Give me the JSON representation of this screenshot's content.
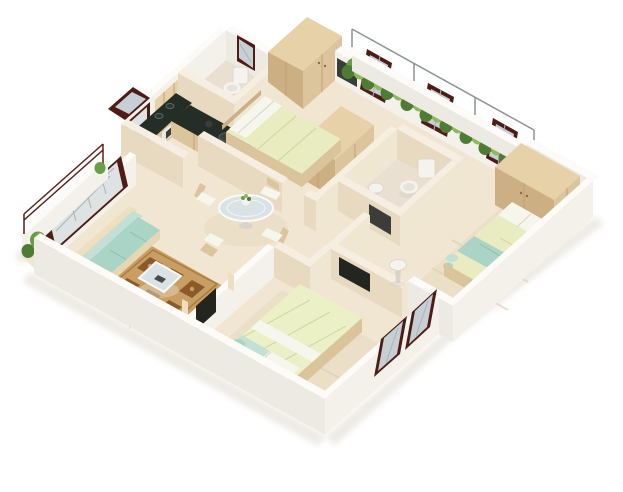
{
  "scene": {
    "type": "isometric-3d-floor-plan-render",
    "bedrooms": 3,
    "bathrooms": 2,
    "rooms": [
      "living-room",
      "kitchen",
      "dining-area",
      "hallway",
      "bathroom-1",
      "bathroom-2",
      "bedroom-1",
      "bedroom-2",
      "bedroom-3",
      "balcony-terrace",
      "left-balcony",
      "vestibule"
    ],
    "furniture": [
      "l-shaped-sofa",
      "coffee-table",
      "patterned-area-rug",
      "tv-panel",
      "round-glass-dining-table",
      "dining-chairs",
      "l-shaped-kitchen-counter",
      "gas-stove",
      "oven",
      "upper-cabinets",
      "kitchen-sink",
      "double-bed-1",
      "double-bed-2",
      "double-bed-3",
      "wardrobe-1",
      "wardrobe-2",
      "wardrobe-3",
      "toilet-1",
      "toilet-2",
      "pedestal-sink",
      "wash-basin",
      "planter-shrubs",
      "maroon-casement-windows",
      "balcony-railing"
    ]
  },
  "colors": {
    "background": "#ffffff",
    "floor": "#f1e6d1",
    "floor_outdoor": "#ebdfc8",
    "floor_bath": "#e9e0d2",
    "rug_bed": "#ecdfc8",
    "rug_streak": "#e0d2b6",
    "wall_white_top": "#fcfbf8",
    "wall_white_light": "#f4f1ea",
    "wall_white_dim": "#eceae2",
    "wall_cream_top": "#f6efe1",
    "wall_cream_light": "#f0e7d3",
    "wall_cream_dim": "#e7dac0",
    "wood_top": "#e6d1a8",
    "wood_light": "#dcc49c",
    "wood_dim": "#ccb083",
    "wood_seam": "#c0a173",
    "wood_base": "#d9c49c",
    "counter_dark": "#242e27",
    "appliance_dark": "#3a3d38",
    "appliance_light": "#ebe8e2",
    "frame_maroon": "#4f1b15",
    "glass": "#c6cfd4",
    "glass_frost": "#dde2e3",
    "glass_line": "#aab4b8",
    "glass_inner": "#eef3f3",
    "plant_dark": "#4e7c34",
    "plant_mid": "#699e46",
    "plant_light": "#8db95f",
    "sofa_cream": "#eedfbe",
    "sofa_front": "#e7d6b2",
    "aqua": "#a9d4c6",
    "aqua_light": "#c2e0d4",
    "aqua_line": "#8fc0b1",
    "duvet": "#e9ecc0",
    "duvet2": "#ebf0c6",
    "duvet_fold": "#d3d9a4",
    "pillow": "#f5f7ec",
    "rug_tan": "#c99e62",
    "rug_brown": "#8a5a2a",
    "rug_border": "#a87c42",
    "ceramic": "#f5f3ee",
    "ceramic_shadow": "#d9d4ca",
    "tv_dark": "#23261f",
    "railing": "#8d9496",
    "railing_maroon": "#5a2018",
    "shadow": "#cfc6b4",
    "table_glass": "#d9e2e4",
    "white_trim": "#fafaf7",
    "sink_dark": "#39433d",
    "sink_rim": "#55605a",
    "burner": "#2c3630",
    "burner_ring": "#5c6860",
    "handle": "#8a6a42"
  }
}
